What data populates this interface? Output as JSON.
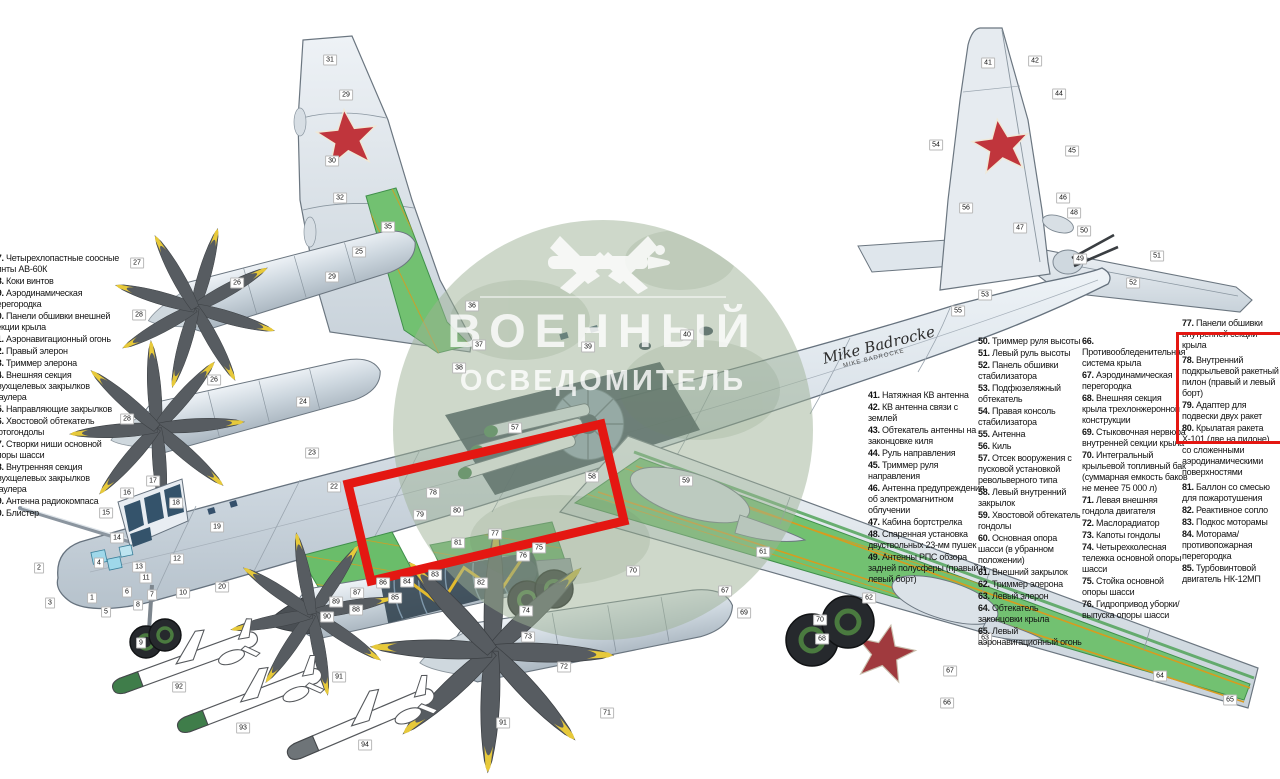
{
  "watermark": {
    "line1": "ВОЕННЫЙ",
    "line2": "ОСВЕДОМИТЕЛЬ"
  },
  "signature": {
    "name": "Mike Badrocke",
    "sub": "MIKE BADROCKE"
  },
  "colors": {
    "accent_red": "#e41712",
    "wing_green": "#72c171",
    "rib_yellow": "#d89b1e",
    "star_red": "#c0353c",
    "watermark_green": "#9eb196",
    "prop_yellow": "#e7c93a"
  },
  "parts_left": [
    {
      "num": "27.",
      "text": "Четырехлопастные соосные винты АВ-60К"
    },
    {
      "num": "28.",
      "text": "Коки винтов"
    },
    {
      "num": "29.",
      "text": "Аэродинамическая перегородка"
    },
    {
      "num": "30.",
      "text": "Панели обшивки внешней секции крыла"
    },
    {
      "num": "31.",
      "text": "Аэронавигационный огонь"
    },
    {
      "num": "32.",
      "text": "Правый элерон"
    },
    {
      "num": "33.",
      "text": "Триммер элерона"
    },
    {
      "num": "34.",
      "text": "Внешняя секция двухщелевых закрылков Фаулера"
    },
    {
      "num": "35.",
      "text": "Направляющие закрылков"
    },
    {
      "num": "36.",
      "text": "Хвостовой обтекатель мотогондолы"
    },
    {
      "num": "37.",
      "text": "Створки ниши основной опоры шасси"
    },
    {
      "num": "38.",
      "text": "Внутренняя секция двухщелевых закрылков Фаулера"
    },
    {
      "num": "39.",
      "text": "Антенна радиокомпаса"
    },
    {
      "num": "40.",
      "text": "Блистер"
    }
  ],
  "parts_41": [
    {
      "num": "41.",
      "text": "Натяжная КВ антенна"
    },
    {
      "num": "42.",
      "text": "КВ антенна связи с землей"
    },
    {
      "num": "43.",
      "text": "Обтекатель антенны на законцовке киля"
    },
    {
      "num": "44.",
      "text": "Руль направления"
    },
    {
      "num": "45.",
      "text": "Триммер руля направления"
    },
    {
      "num": "46.",
      "text": "Антенна предупреждения об электромагнитном облучении"
    },
    {
      "num": "47.",
      "text": "Кабина бортстрелка"
    },
    {
      "num": "48.",
      "text": "Спаренная установка двуствольных 23-мм пушек"
    },
    {
      "num": "49.",
      "text": "Антенны РПС обзора задней полусферы (правый и левый борт)"
    }
  ],
  "parts_50": [
    {
      "num": "50.",
      "text": "Триммер руля высоты"
    },
    {
      "num": "51.",
      "text": "Левый руль высоты"
    },
    {
      "num": "52.",
      "text": "Панель обшивки стабилизатора"
    },
    {
      "num": "53.",
      "text": "Подфюзеляжный обтекатель"
    },
    {
      "num": "54.",
      "text": "Правая консоль стабилизатора"
    },
    {
      "num": "55.",
      "text": "Антенна"
    },
    {
      "num": "56.",
      "text": "Киль"
    },
    {
      "num": "57.",
      "text": "Отсек вооружения с пусковой установкой револьверного типа"
    },
    {
      "num": "58.",
      "text": "Левый внутренний закрылок"
    },
    {
      "num": "59.",
      "text": "Хвостовой обтекатель гондолы"
    },
    {
      "num": "60.",
      "text": "Основная опора шасси (в убранном положении)"
    },
    {
      "num": "61.",
      "text": "Внешний закрылок"
    },
    {
      "num": "62.",
      "text": "Триммер элерона"
    },
    {
      "num": "63.",
      "text": "Левый элерон"
    },
    {
      "num": "64.",
      "text": "Обтекатель законцовки крыла"
    },
    {
      "num": "65.",
      "text": "Левый аэронавигационный огонь"
    }
  ],
  "parts_66": [
    {
      "num": "66.",
      "text": "Противообледенительная система крыла"
    },
    {
      "num": "67.",
      "text": "Аэродинамическая перегородка"
    },
    {
      "num": "68.",
      "text": "Внешняя секция крыла трехлонжеронной конструкции"
    },
    {
      "num": "69.",
      "text": "Стыковочная нервюра внутренней секции крыла"
    },
    {
      "num": "70.",
      "text": "Интегральный крыльевой топливный бак (суммарная емкость баков не менее 75 000 л)"
    },
    {
      "num": "71.",
      "text": "Левая внешняя гондола двигателя"
    },
    {
      "num": "72.",
      "text": "Маслорадиатор"
    },
    {
      "num": "73.",
      "text": "Капоты гондолы"
    },
    {
      "num": "74.",
      "text": "Четырехколесная тележка основной опоры шасси"
    },
    {
      "num": "75.",
      "text": "Стойка основной опоры шасси"
    },
    {
      "num": "76.",
      "text": "Гидропривод уборки/выпуска опоры шасси"
    }
  ],
  "parts_77_top": [
    {
      "num": "77.",
      "text": "Панели обшивки внутренней секции крыла"
    }
  ],
  "parts_77_boxed": [
    {
      "num": "78.",
      "text": "Внутренний подкрыльевой ракетный пилон (правый и левый борт)"
    },
    {
      "num": "79.",
      "text": "Адаптер для подвески двух ракет"
    },
    {
      "num": "80.",
      "text": "Крылатая ракета Х-101 (две на пилоне) со сложенными аэродинамическими поверхностями"
    }
  ],
  "parts_77_bottom": [
    {
      "num": "81.",
      "text": "Баллон со смесью для пожаротушения"
    },
    {
      "num": "82.",
      "text": "Реактивное сопло"
    },
    {
      "num": "83.",
      "text": "Подкос моторамы"
    },
    {
      "num": "84.",
      "text": "Моторама/противопожарная перегородка"
    },
    {
      "num": "85.",
      "text": "Турбовинтовой двигатель НК-12МП"
    }
  ],
  "callouts": [
    {
      "n": "1",
      "x": 92,
      "y": 598
    },
    {
      "n": "2",
      "x": 39,
      "y": 568
    },
    {
      "n": "3",
      "x": 50,
      "y": 603
    },
    {
      "n": "4",
      "x": 99,
      "y": 563
    },
    {
      "n": "5",
      "x": 106,
      "y": 612
    },
    {
      "n": "6",
      "x": 127,
      "y": 592
    },
    {
      "n": "7",
      "x": 152,
      "y": 595
    },
    {
      "n": "8",
      "x": 138,
      "y": 605
    },
    {
      "n": "9",
      "x": 141,
      "y": 643
    },
    {
      "n": "10",
      "x": 183,
      "y": 593
    },
    {
      "n": "11",
      "x": 146,
      "y": 578
    },
    {
      "n": "12",
      "x": 177,
      "y": 559
    },
    {
      "n": "13",
      "x": 139,
      "y": 567
    },
    {
      "n": "14",
      "x": 117,
      "y": 538
    },
    {
      "n": "15",
      "x": 106,
      "y": 513
    },
    {
      "n": "16",
      "x": 127,
      "y": 493
    },
    {
      "n": "17",
      "x": 153,
      "y": 481
    },
    {
      "n": "18",
      "x": 176,
      "y": 503
    },
    {
      "n": "19",
      "x": 217,
      "y": 527
    },
    {
      "n": "20",
      "x": 222,
      "y": 587
    },
    {
      "n": "22",
      "x": 334,
      "y": 487
    },
    {
      "n": "23",
      "x": 312,
      "y": 453
    },
    {
      "n": "24",
      "x": 303,
      "y": 402
    },
    {
      "n": "25",
      "x": 359,
      "y": 252
    },
    {
      "n": "26",
      "x": 237,
      "y": 283
    },
    {
      "n": "27",
      "x": 137,
      "y": 263
    },
    {
      "n": "28",
      "x": 139,
      "y": 315
    },
    {
      "n": "26",
      "x": 214,
      "y": 380
    },
    {
      "n": "28",
      "x": 127,
      "y": 419
    },
    {
      "n": "29",
      "x": 346,
      "y": 95
    },
    {
      "n": "29",
      "x": 332,
      "y": 277
    },
    {
      "n": "30",
      "x": 332,
      "y": 161
    },
    {
      "n": "31",
      "x": 330,
      "y": 60
    },
    {
      "n": "32",
      "x": 340,
      "y": 198
    },
    {
      "n": "35",
      "x": 388,
      "y": 227
    },
    {
      "n": "36",
      "x": 472,
      "y": 306
    },
    {
      "n": "37",
      "x": 479,
      "y": 345
    },
    {
      "n": "38",
      "x": 459,
      "y": 368
    },
    {
      "n": "39",
      "x": 588,
      "y": 347
    },
    {
      "n": "40",
      "x": 687,
      "y": 335
    },
    {
      "n": "41",
      "x": 988,
      "y": 63
    },
    {
      "n": "42",
      "x": 1035,
      "y": 61
    },
    {
      "n": "44",
      "x": 1059,
      "y": 94
    },
    {
      "n": "45",
      "x": 1072,
      "y": 151
    },
    {
      "n": "46",
      "x": 1063,
      "y": 198
    },
    {
      "n": "47",
      "x": 1020,
      "y": 228
    },
    {
      "n": "48",
      "x": 1074,
      "y": 213
    },
    {
      "n": "49",
      "x": 1080,
      "y": 259
    },
    {
      "n": "50",
      "x": 1084,
      "y": 231
    },
    {
      "n": "51",
      "x": 1157,
      "y": 256
    },
    {
      "n": "52",
      "x": 1133,
      "y": 283
    },
    {
      "n": "53",
      "x": 985,
      "y": 295
    },
    {
      "n": "54",
      "x": 936,
      "y": 145
    },
    {
      "n": "55",
      "x": 958,
      "y": 311
    },
    {
      "n": "56",
      "x": 966,
      "y": 208
    },
    {
      "n": "57",
      "x": 515,
      "y": 428
    },
    {
      "n": "58",
      "x": 592,
      "y": 477
    },
    {
      "n": "59",
      "x": 686,
      "y": 481
    },
    {
      "n": "61",
      "x": 763,
      "y": 552
    },
    {
      "n": "62",
      "x": 869,
      "y": 598
    },
    {
      "n": "63",
      "x": 985,
      "y": 638
    },
    {
      "n": "64",
      "x": 1160,
      "y": 676
    },
    {
      "n": "65",
      "x": 1230,
      "y": 700
    },
    {
      "n": "66",
      "x": 947,
      "y": 703
    },
    {
      "n": "67",
      "x": 725,
      "y": 591
    },
    {
      "n": "67",
      "x": 950,
      "y": 671
    },
    {
      "n": "68",
      "x": 822,
      "y": 639
    },
    {
      "n": "69",
      "x": 744,
      "y": 613
    },
    {
      "n": "70",
      "x": 633,
      "y": 571
    },
    {
      "n": "70",
      "x": 820,
      "y": 620
    },
    {
      "n": "71",
      "x": 607,
      "y": 713
    },
    {
      "n": "72",
      "x": 564,
      "y": 667
    },
    {
      "n": "73",
      "x": 528,
      "y": 637
    },
    {
      "n": "74",
      "x": 526,
      "y": 611
    },
    {
      "n": "75",
      "x": 539,
      "y": 548
    },
    {
      "n": "76",
      "x": 523,
      "y": 556
    },
    {
      "n": "77",
      "x": 495,
      "y": 534
    },
    {
      "n": "78",
      "x": 433,
      "y": 493
    },
    {
      "n": "79",
      "x": 420,
      "y": 515
    },
    {
      "n": "80",
      "x": 457,
      "y": 511
    },
    {
      "n": "81",
      "x": 458,
      "y": 543
    },
    {
      "n": "82",
      "x": 481,
      "y": 583
    },
    {
      "n": "83",
      "x": 435,
      "y": 575
    },
    {
      "n": "84",
      "x": 407,
      "y": 582
    },
    {
      "n": "85",
      "x": 395,
      "y": 598
    },
    {
      "n": "86",
      "x": 383,
      "y": 583
    },
    {
      "n": "87",
      "x": 357,
      "y": 593
    },
    {
      "n": "88",
      "x": 356,
      "y": 610
    },
    {
      "n": "89",
      "x": 336,
      "y": 602
    },
    {
      "n": "90",
      "x": 327,
      "y": 617
    },
    {
      "n": "91",
      "x": 339,
      "y": 677
    },
    {
      "n": "91",
      "x": 503,
      "y": 723
    },
    {
      "n": "92",
      "x": 179,
      "y": 687
    },
    {
      "n": "93",
      "x": 243,
      "y": 728
    },
    {
      "n": "94",
      "x": 365,
      "y": 745
    }
  ]
}
